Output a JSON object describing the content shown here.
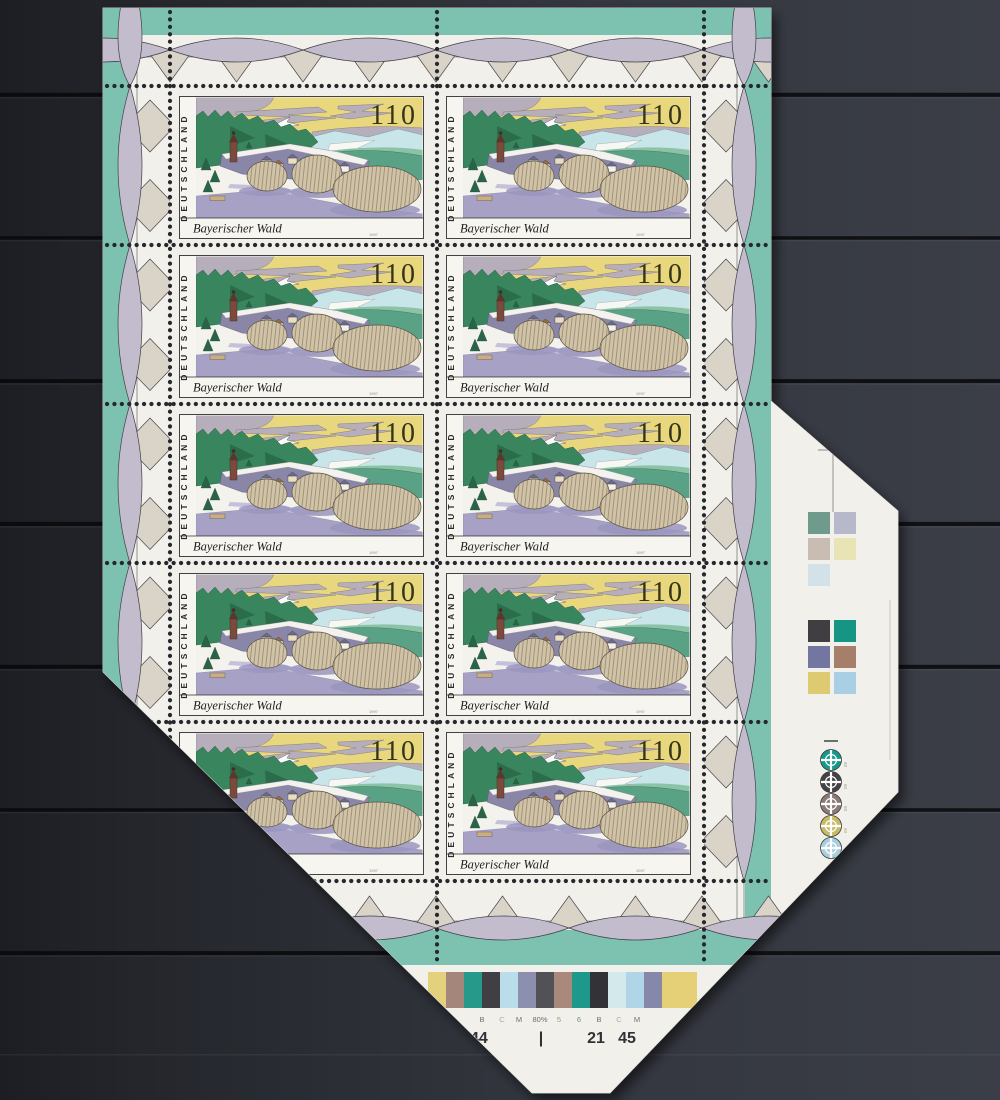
{
  "stamp": {
    "country": "DEUTSCHLAND",
    "denomination": "110",
    "title": "Bayerischer Wald",
    "year": "1997"
  },
  "print_control": {
    "bar_labels": [
      "B",
      "C",
      "M",
      "80%",
      "5",
      "6",
      "B",
      "C",
      "M"
    ],
    "bar_numbers": [
      "44",
      "|",
      "21",
      "45"
    ],
    "bar_patch_colors": [
      "#e3d17d",
      "#a5867a",
      "#27998a",
      "#403f43",
      "#b9dde9",
      "#8d8fae",
      "#515156",
      "#a8897b",
      "#1d988a",
      "#323237",
      "#d3e9ec",
      "#b0d5e6",
      "#8688aa",
      "#e5d078"
    ],
    "swatch_top_colors": [
      "#6f9a8c",
      "#b7b8c9",
      "#c9bcb2",
      "#e9e4b5",
      "#d3e2e8"
    ],
    "swatch_bottom_colors": [
      "#403e41",
      "#169484",
      "#7276a0",
      "#a57f69",
      "#decb71",
      "#a9cfe4"
    ],
    "registration_circle_colors": [
      "#17988a",
      "#434246",
      "#8b7b74",
      "#c8bb66",
      "#a9cfdd"
    ],
    "registration_angle_labels": [
      "60",
      "60",
      "60",
      "60",
      "60"
    ]
  },
  "palette": {
    "selvage_teal": "#7dc2b1",
    "garland_lens": "#c2bccd",
    "garland_triangle": "#d9d3c8",
    "paper": "#f1f0ea",
    "background": "#30333a"
  }
}
